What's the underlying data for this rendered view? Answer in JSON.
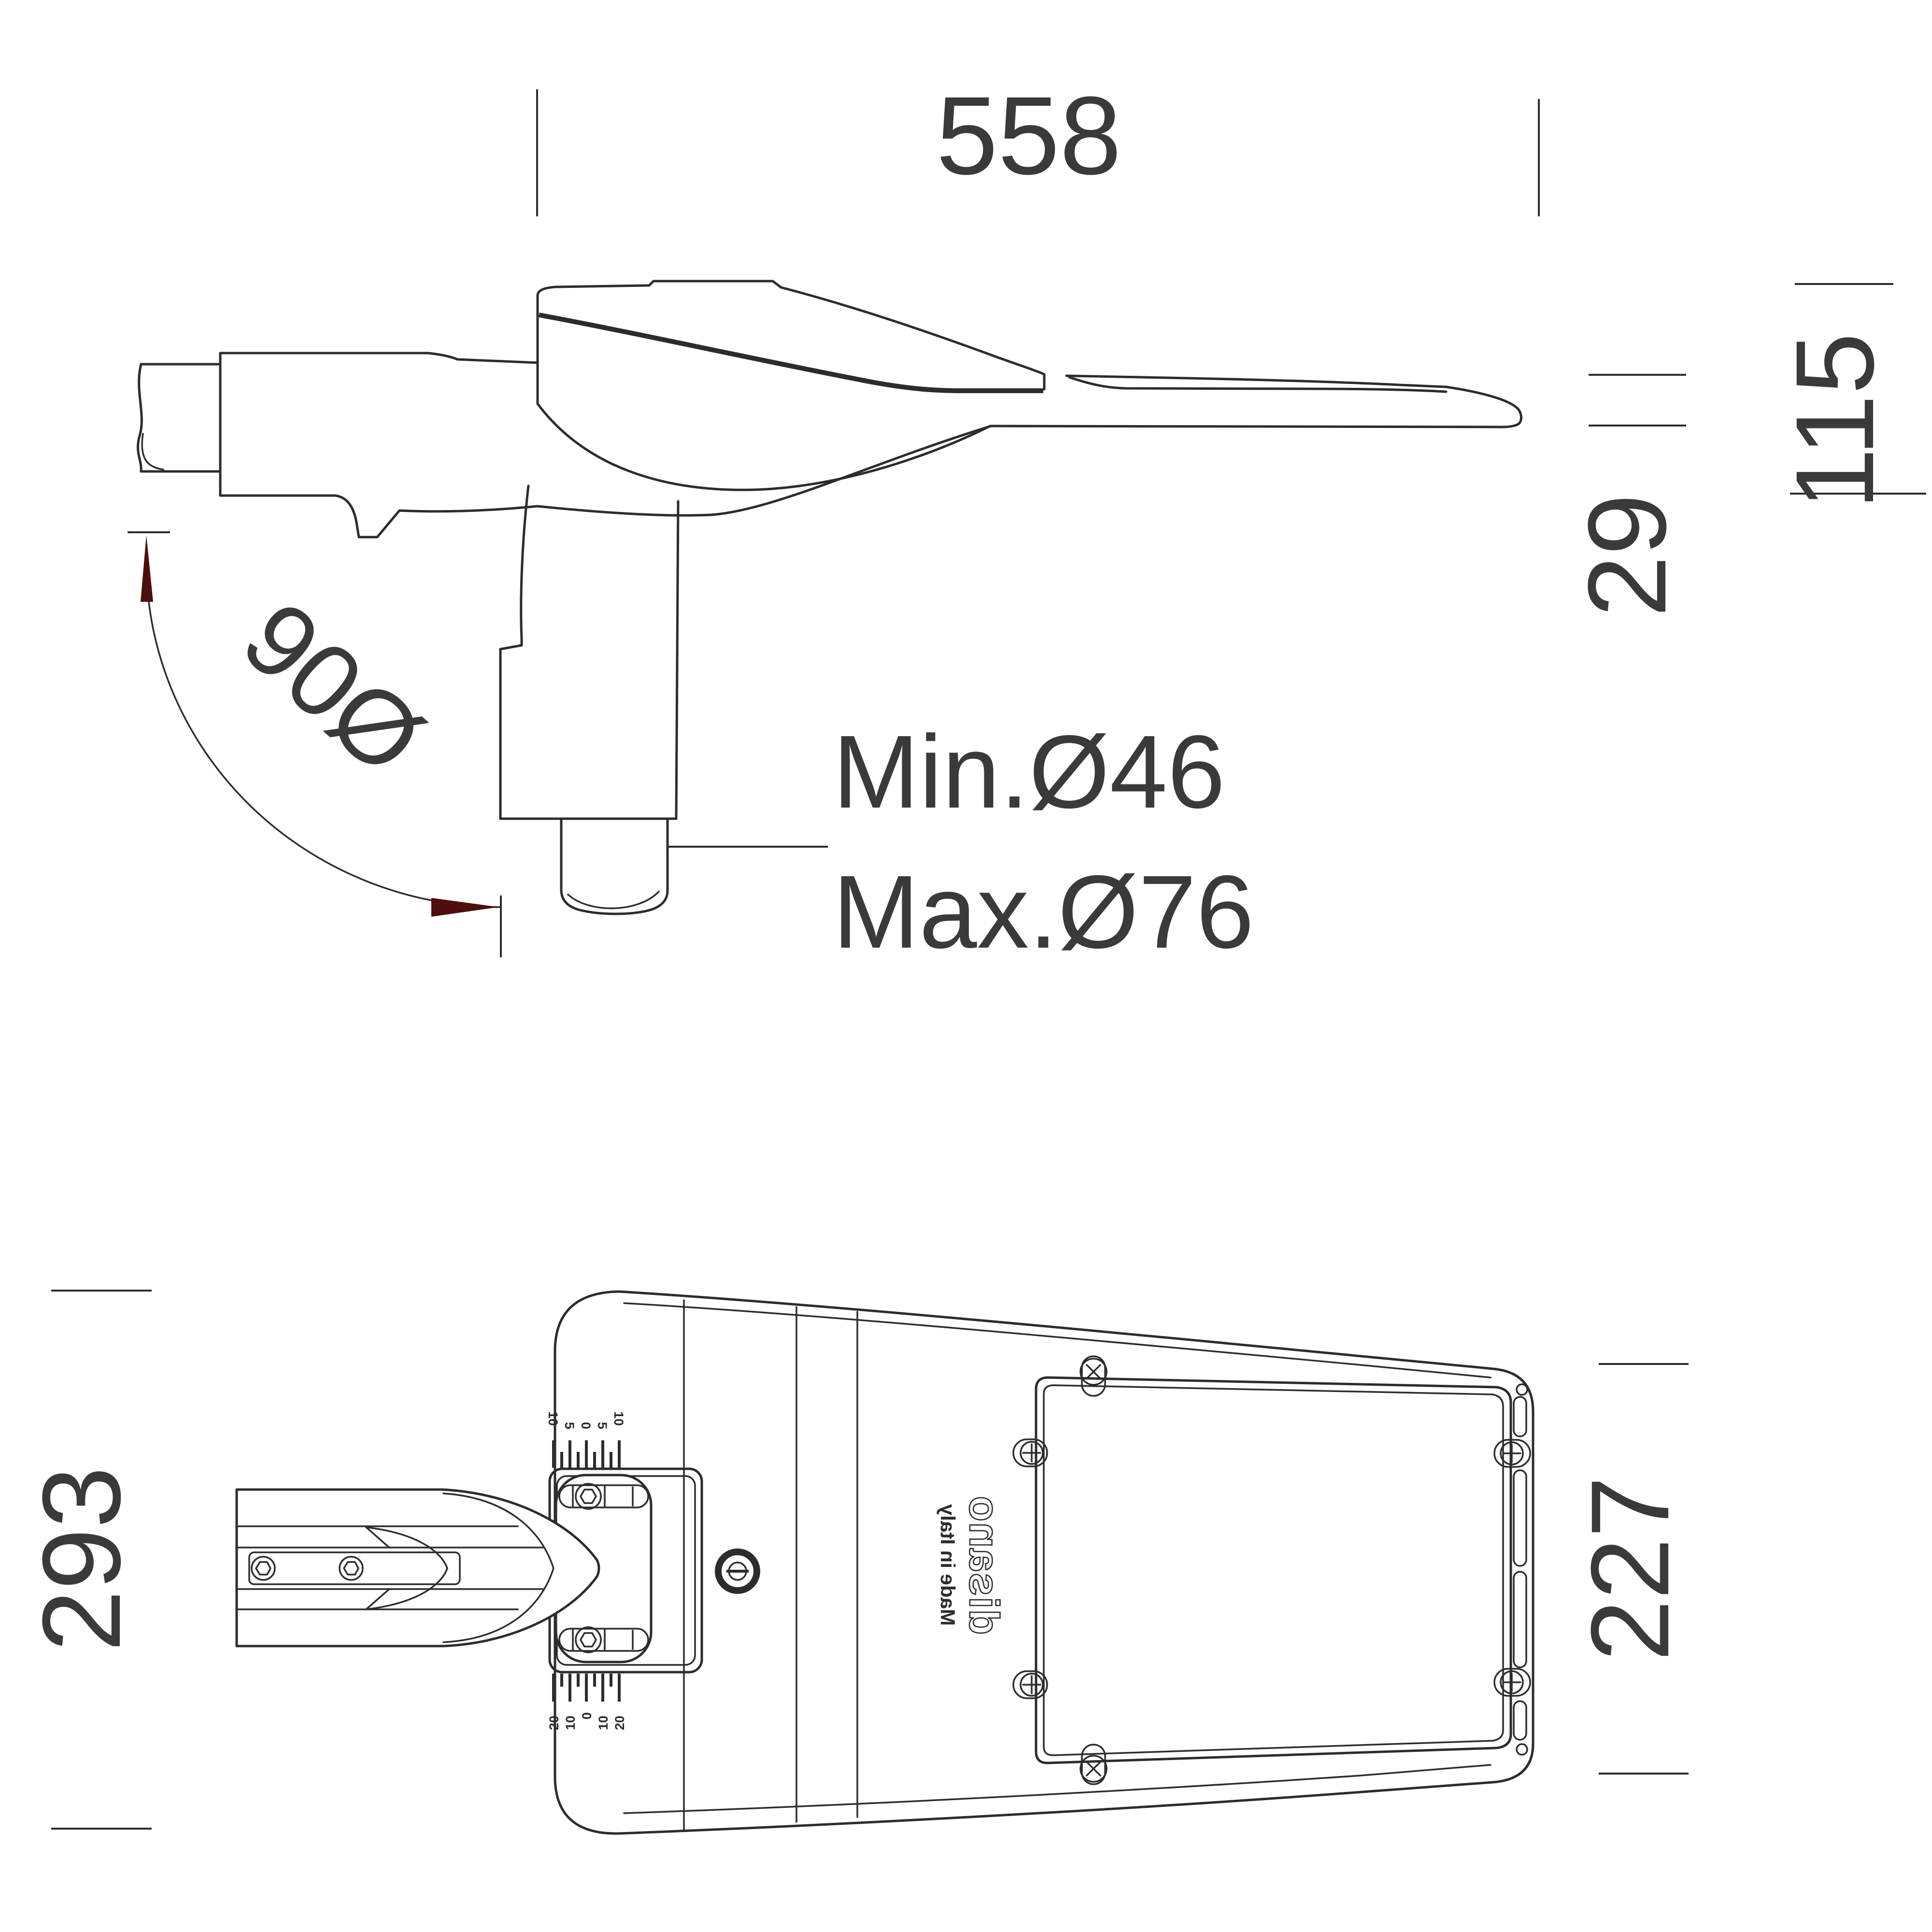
{
  "drawing": {
    "title": "street light luminaire dimensional drawing",
    "colors": {
      "line": "#2c2c2e",
      "text": "#3a3a3c",
      "arrow": "#4c0f0d",
      "background": "#ffffff"
    },
    "side_view": {
      "width_mm": "558",
      "total_height_mm": "115",
      "tip_thickness_mm": "29",
      "rotation_label": "90Ø",
      "pole_min_label": "Min.Ø46",
      "pole_max_label": "Max.Ø76"
    },
    "bottom_view": {
      "body_width_mm": "293",
      "tail_width_mm": "227",
      "brand": "disano",
      "origin": "Made in Italy",
      "tilt_scale_top": [
        "10",
        "5",
        "0",
        "5",
        "10"
      ],
      "tilt_scale_bottom": [
        "20",
        "10",
        "0",
        "10",
        "20"
      ]
    }
  }
}
